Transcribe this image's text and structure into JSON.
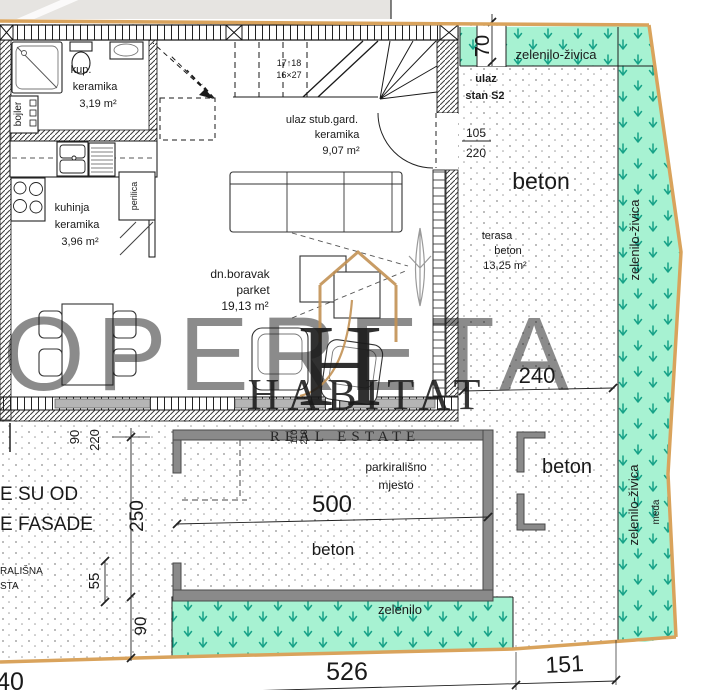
{
  "palette": {
    "boundary": "#d9a35c",
    "green": "#a7f2d2",
    "hedge_arrow": "#17a288",
    "wall_gray": "#8a8a8a",
    "watermark_gold": "#c39255",
    "watermark_gray": "#dcdcdc"
  },
  "rooms": {
    "bathroom": {
      "name": "kup.",
      "finish": "keramika",
      "area": "3,19 m²"
    },
    "kitchen": {
      "name": "kuhinja",
      "finish": "keramika",
      "area": "3,96 m²"
    },
    "entry_hall": {
      "name": "ulaz stub.gard.",
      "finish": "keramika",
      "area": "9,07 m²"
    },
    "living": {
      "name": "dn.boravak",
      "finish": "parket",
      "area": "19,13 m²"
    },
    "terrace": {
      "name": "terasa",
      "finish": "beton",
      "area": "13,25 m²"
    },
    "boiler": "bojler",
    "washer": "perilica",
    "stairs": {
      "line1": "17↑18",
      "line2": "16×27"
    }
  },
  "site": {
    "hedge_top": "zelenilo-živica",
    "hedge_right_upper": "zelenilo-živica",
    "hedge_right_lower": "zelenilo-živica",
    "boundary_line": "međa",
    "green_bottom": "zelenilo",
    "concrete_terrace": "beton",
    "concrete_right": "beton",
    "concrete_parking": "beton",
    "parking_line1": "parkirališno",
    "parking_line2": "mjesto",
    "entrance_line1": "ulaz",
    "entrance_line2": "stan S2"
  },
  "dims": {
    "hedge_top_width": "70",
    "entry_door_w": "105",
    "entry_door_h": "220",
    "terrace_width": "240",
    "parking_length": "500",
    "plot_bottom_main": "526",
    "plot_bottom_right": "151",
    "plot_bottom_left_partial": "40",
    "south_250": "250",
    "south_55": "55",
    "south_90": "90",
    "window_w": "90",
    "window_h": "220",
    "opening_w": "110",
    "opening_h": "210"
  },
  "notes": {
    "cut_line1": "E SU OD",
    "cut_line2": "E FASADE",
    "cut_line3": "RALIŠNA",
    "cut_line4": "STA"
  },
  "watermark": {
    "monogram": "H",
    "brand": "HABITAT",
    "tagline": "REAL ESTATE",
    "ghost": "OPERETA"
  }
}
